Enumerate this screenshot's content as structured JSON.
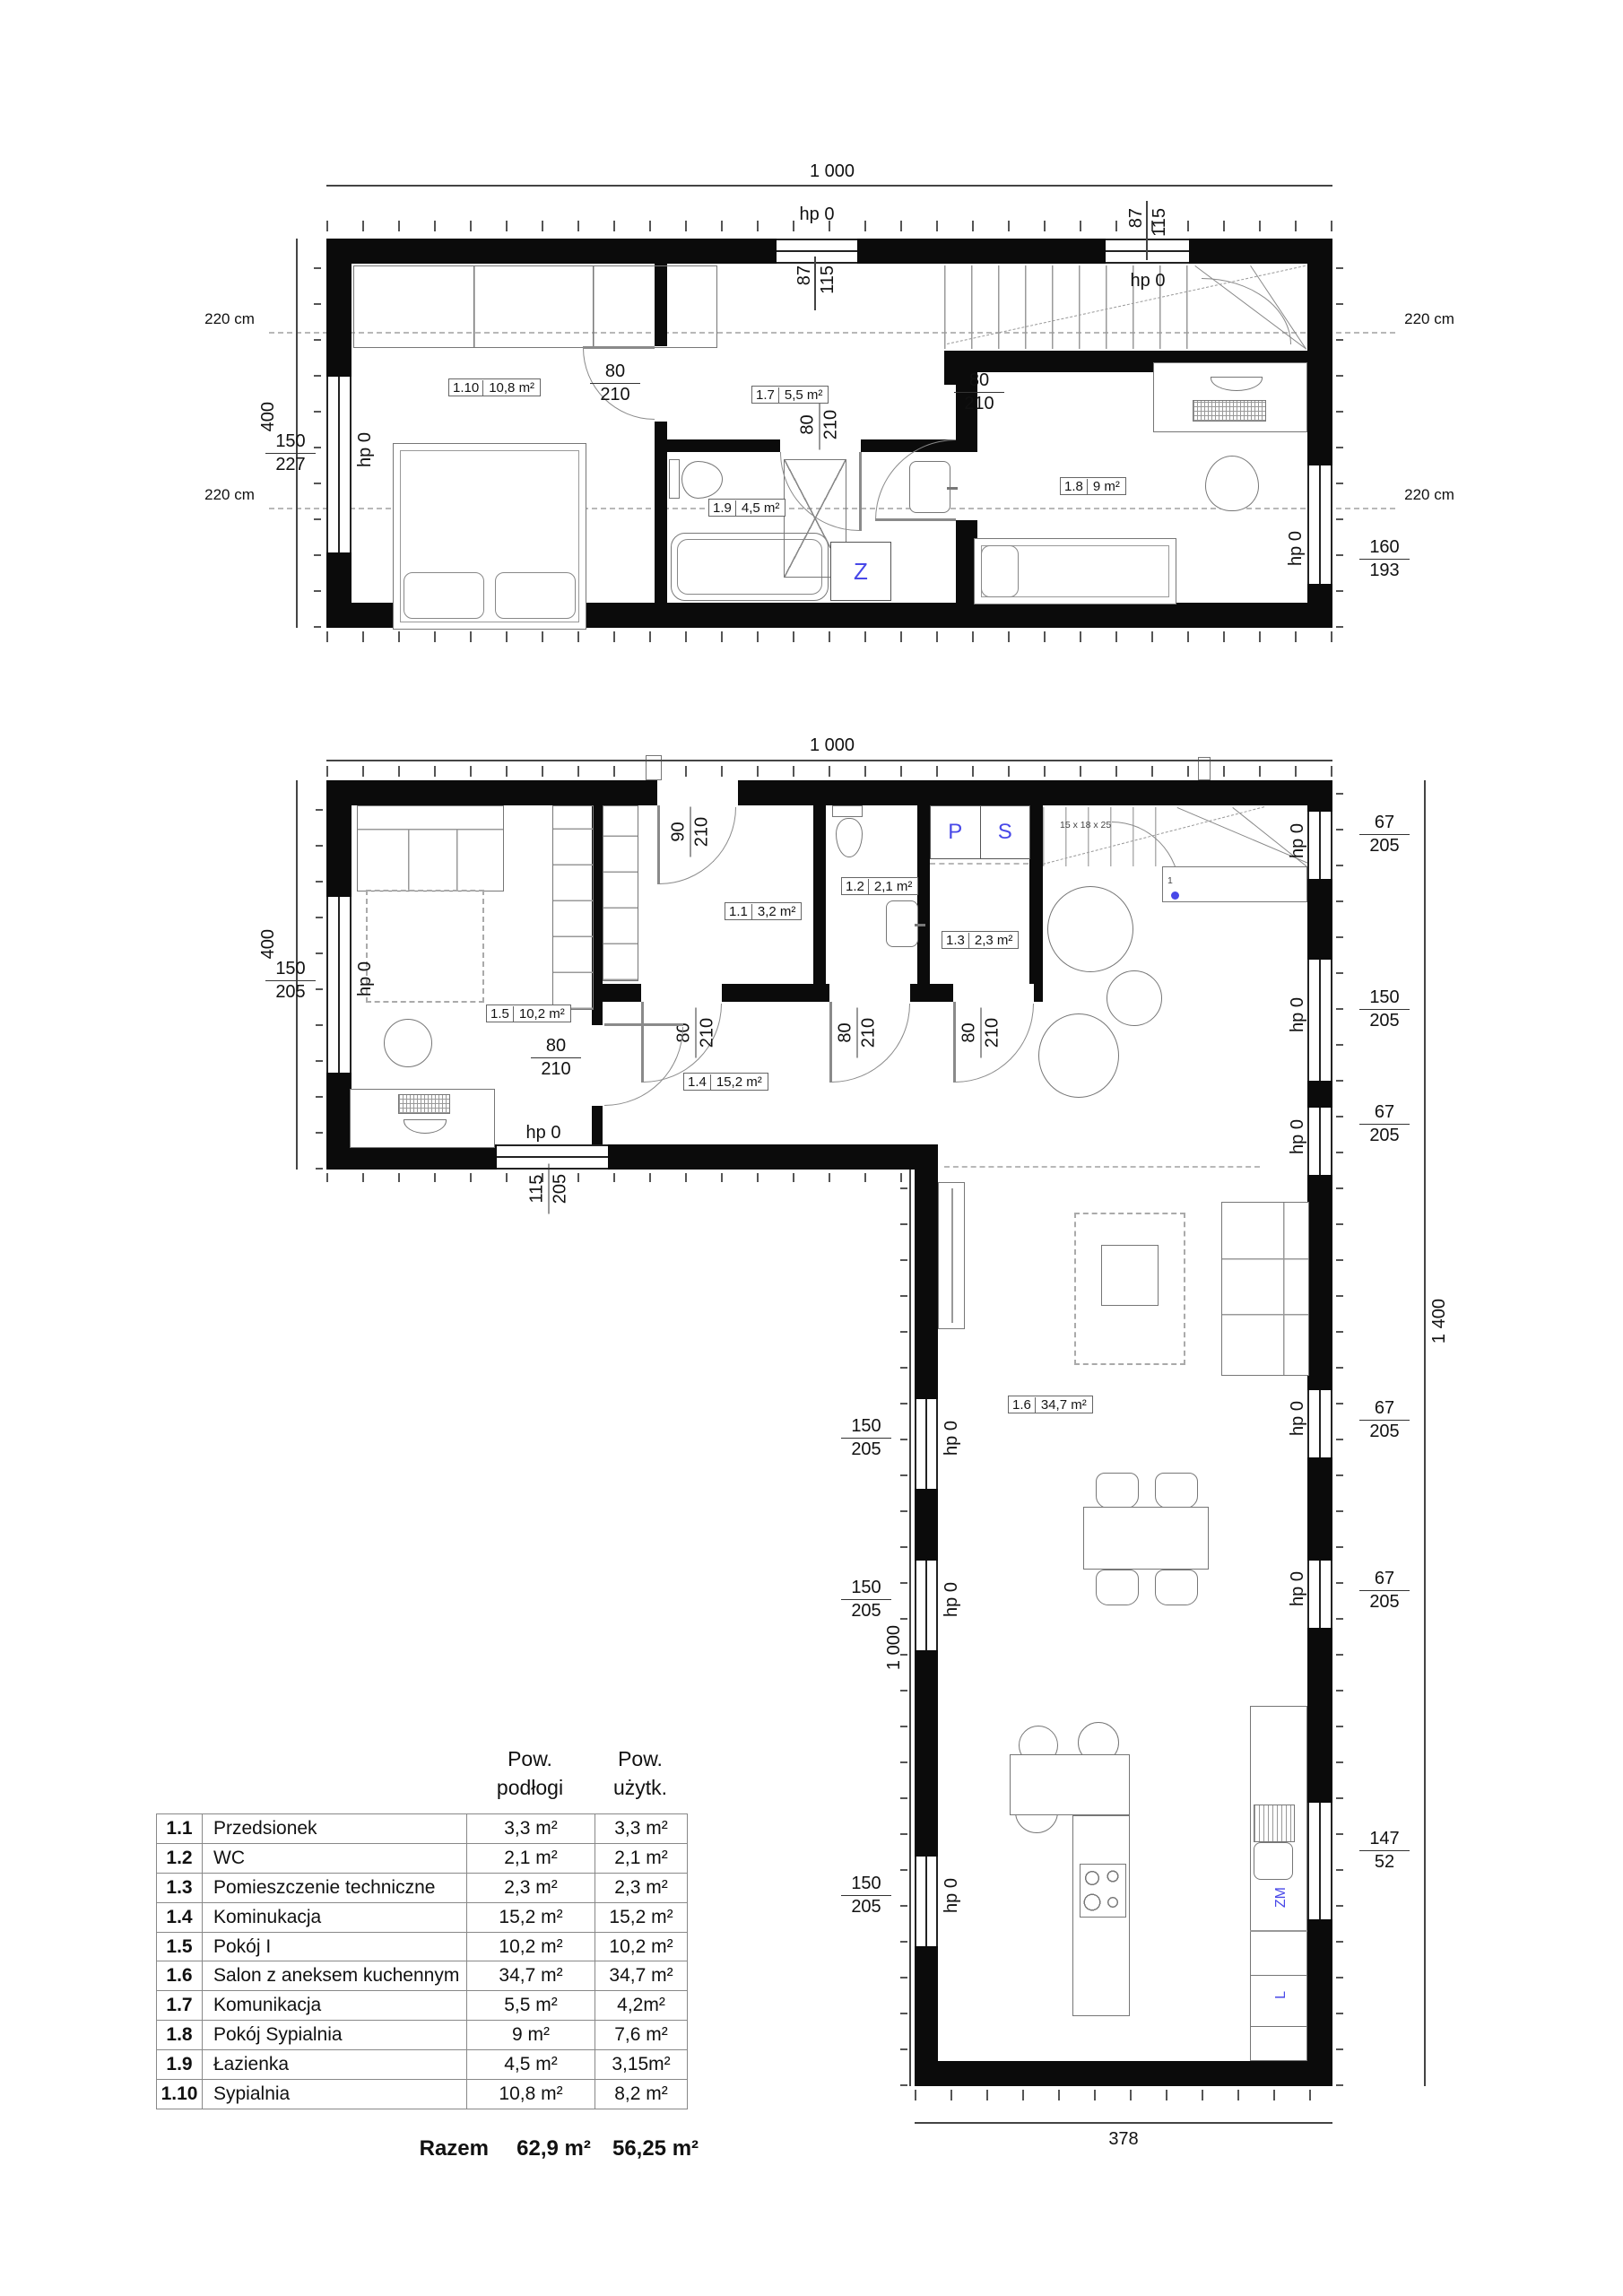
{
  "colors": {
    "accent_blue": "#4848e8",
    "wall_black": "#0b0b0b"
  },
  "labels": {
    "hp0": "hp 0",
    "d80": "80",
    "d210": "210",
    "d90": "90",
    "d87": "87",
    "d115": "115",
    "d150": "150",
    "d205": "205",
    "d227": "227",
    "d160": "160",
    "d193": "193",
    "d67": "67",
    "d147": "147",
    "d52": "52",
    "dim1000": "1 000",
    "dim400": "400",
    "dim1400": "1 400",
    "dim378": "378",
    "level220": "220 cm",
    "stair_spec": "15 x 18 x 25",
    "step1": "1",
    "z": "Z",
    "p": "P",
    "s": "S",
    "zm": "ZM",
    "l": "L"
  },
  "plans": {
    "upper": {
      "rooms": {
        "r110": {
          "no": "1.10",
          "area": "10,8 m²"
        },
        "r17": {
          "no": "1.7",
          "area": "5,5 m²"
        },
        "r19": {
          "no": "1.9",
          "area": "4,5 m²"
        },
        "r18": {
          "no": "1.8",
          "area": "9 m²"
        }
      }
    },
    "ground": {
      "rooms": {
        "r11": {
          "no": "1.1",
          "area": "3,2 m²"
        },
        "r12": {
          "no": "1.2",
          "area": "2,1 m²"
        },
        "r13": {
          "no": "1.3",
          "area": "2,3 m²"
        },
        "r14": {
          "no": "1.4",
          "area": "15,2 m²"
        },
        "r15": {
          "no": "1.5",
          "area": "10,2 m²"
        },
        "r16": {
          "no": "1.6",
          "area": "34,7 m²"
        }
      }
    }
  },
  "table": {
    "headers": {
      "pow1": "Pow.",
      "pow1b": "podłogi",
      "pow2": "Pow.",
      "pow2b": "użytk."
    },
    "rows": [
      {
        "no": "1.1",
        "name": "Przedsionek",
        "floor": "3,3 m²",
        "usable": "3,3 m²"
      },
      {
        "no": "1.2",
        "name": "WC",
        "floor": "2,1 m²",
        "usable": "2,1 m²"
      },
      {
        "no": "1.3",
        "name": "Pomieszczenie techniczne",
        "floor": "2,3 m²",
        "usable": "2,3 m²"
      },
      {
        "no": "1.4",
        "name": "Kominukacja",
        "floor": "15,2 m²",
        "usable": "15,2 m²"
      },
      {
        "no": "1.5",
        "name": "Pokój I",
        "floor": "10,2 m²",
        "usable": "10,2 m²"
      },
      {
        "no": "1.6",
        "name": "Salon z aneksem kuchennym",
        "floor": "34,7 m²",
        "usable": "34,7 m²"
      },
      {
        "no": "1.7",
        "name": "Komunikacja",
        "floor": "5,5 m²",
        "usable": "4,2m²"
      },
      {
        "no": "1.8",
        "name": "Pokój Sypialnia",
        "floor": "9 m²",
        "usable": "7,6 m²"
      },
      {
        "no": "1.9",
        "name": "Łazienka",
        "floor": "4,5 m²",
        "usable": "3,15m²"
      },
      {
        "no": "1.10",
        "name": "Sypialnia",
        "floor": "10,8 m²",
        "usable": "8,2 m²"
      }
    ],
    "total": {
      "label": "Razem",
      "floor": "62,9 m²",
      "usable": "56,25 m²"
    }
  }
}
